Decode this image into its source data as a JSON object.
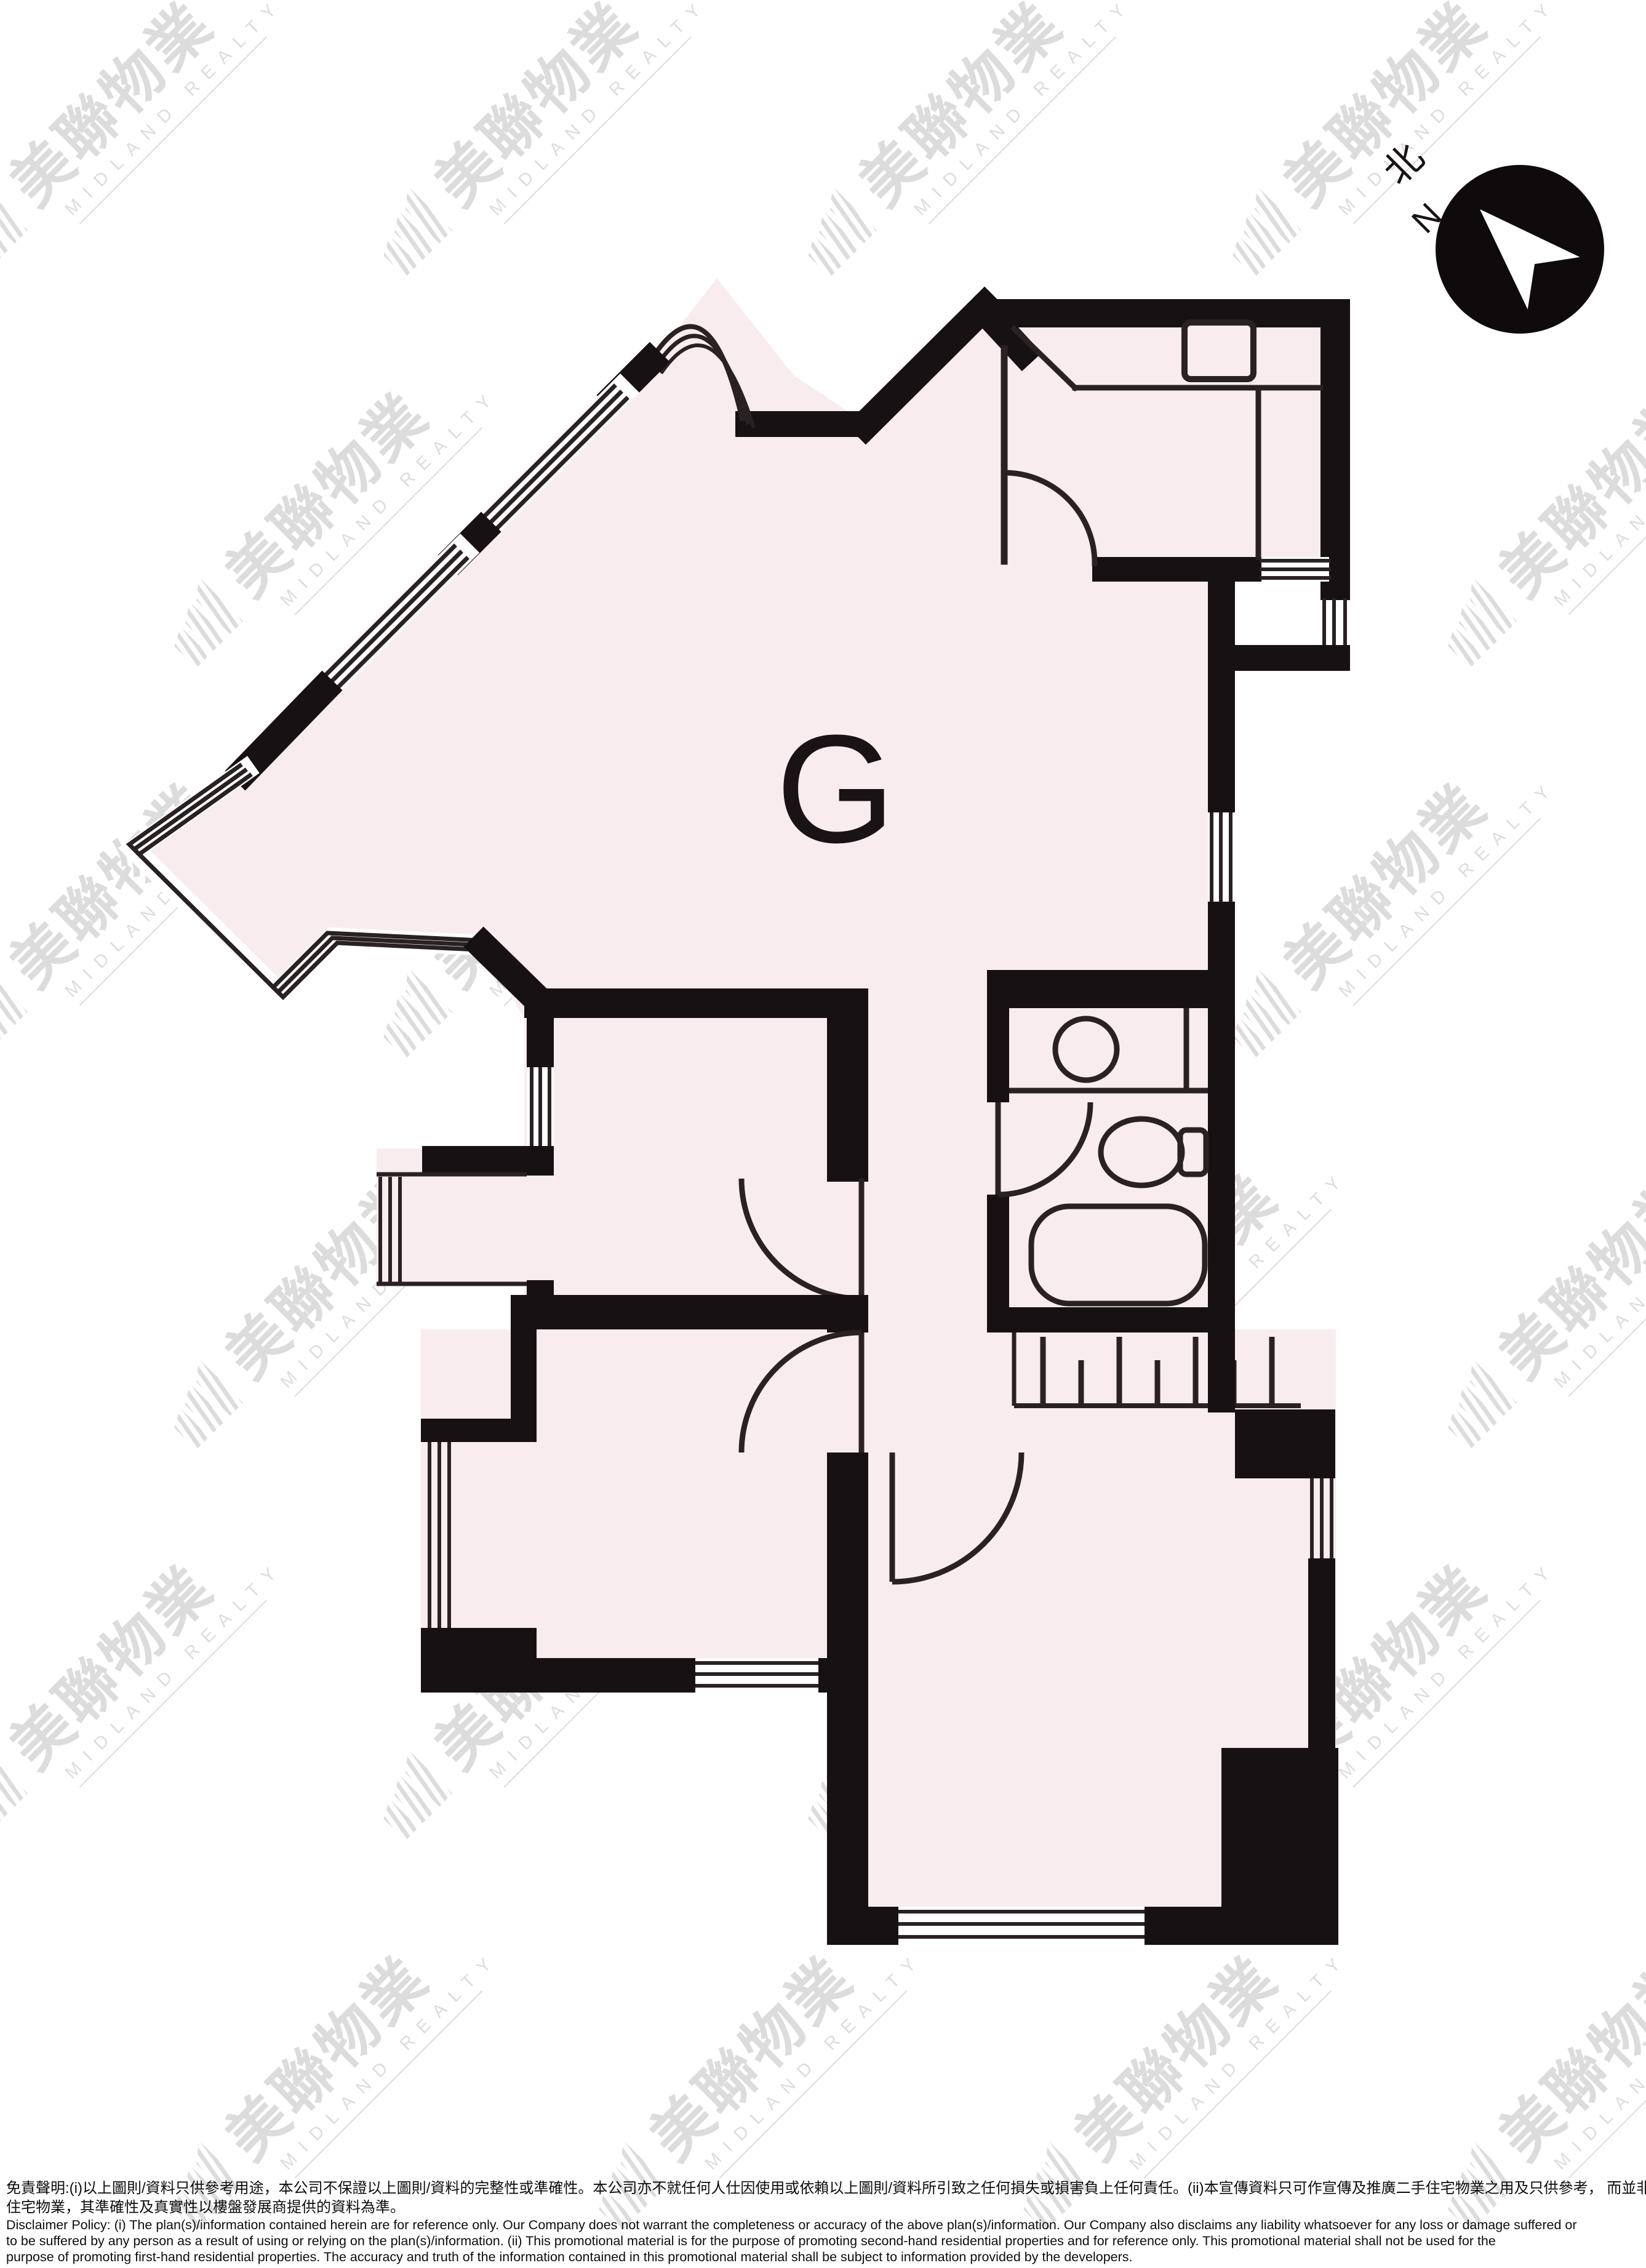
{
  "floor_plan": {
    "unit_label": "G"
  },
  "compass": {
    "north_cn": "北",
    "north_en": "N"
  },
  "watermark": {
    "brand_cn": "美聯物業",
    "brand_en": "MIDLAND REALTY"
  },
  "disclaimer": {
    "lines": [
      "免責聲明:(i)以上圖則/資料只供參考用途，本公司不保證以上圖則/資料的完整性或準確性。本公司亦不就任何人仕因使用或依賴以上圖則/資料所引致之任何損失或損害負上任何責任。(ii)本宣傳資料只可作宣傳及推廣二手住宅物業之用及只供參考， 而並非及不可用作宣傳推廣任何一手",
      "住宅物業，其準確性及真實性以樓盤發展商提供的資料為準。",
      "Disclaimer Policy: (i) The plan(s)/information contained herein are for reference only. Our Company does not warrant the completeness or accuracy of the above plan(s)/information. Our Company also disclaims any liability whatsoever for any loss or damage suffered or",
      "to be suffered by any person as a result of using or relying on the plan(s)/information. (ii) This promotional material is for the purpose of promoting second-hand residential properties and for reference only. This promotional material shall not be used for the",
      "purpose of promoting first-hand residential properties. The accuracy and truth of the information contained in this promotional material shall be subject to information provided by the developers."
    ]
  }
}
